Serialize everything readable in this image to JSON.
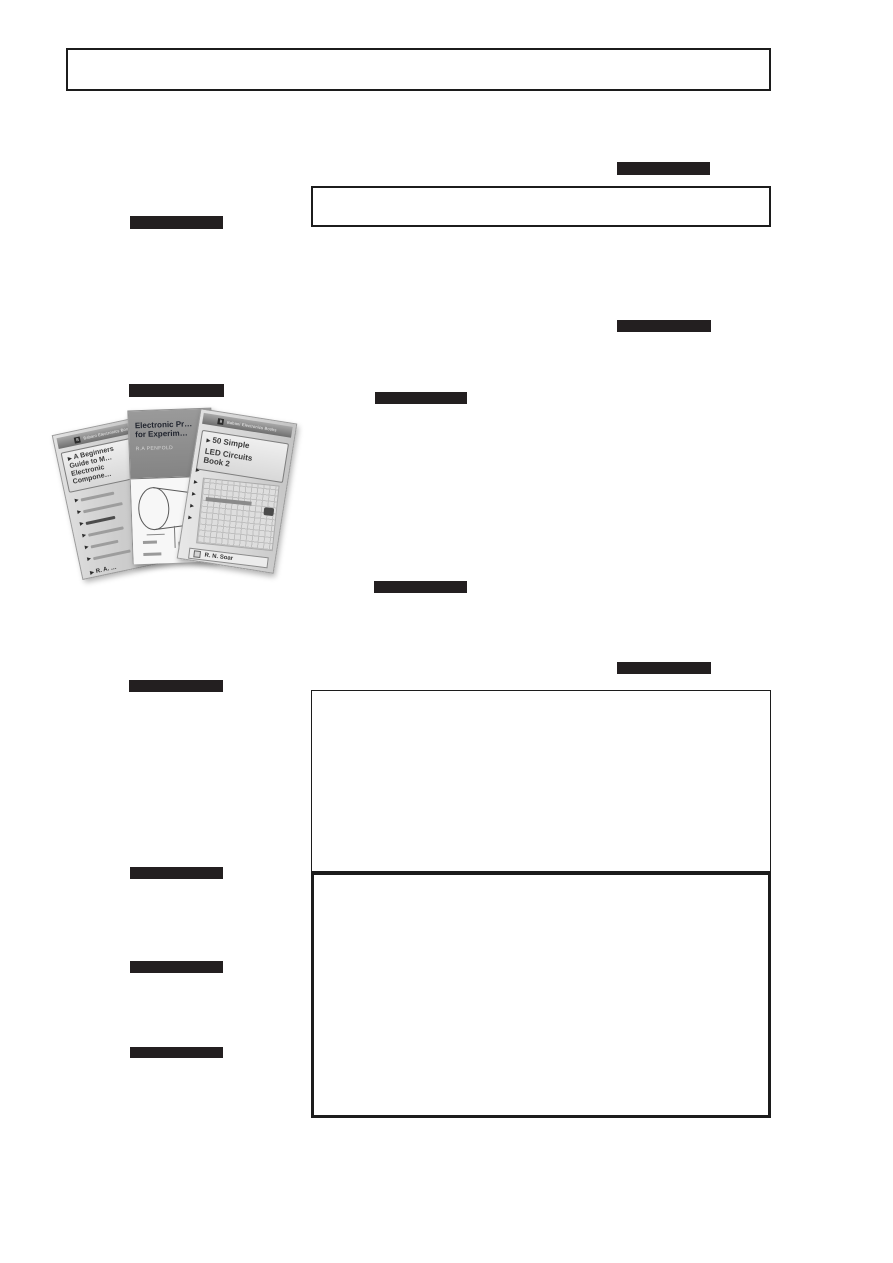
{
  "page": {
    "background_color": "#ffffff",
    "ink_color": "#231f20",
    "border_color": "#1c1c1c"
  },
  "icons": {
    "bullet": "▶",
    "publisher_logo_glyph": "B"
  },
  "books_photo": {
    "left_book": {
      "brand": "Babani Electronics Books",
      "title_line1": "A Beginners",
      "title_line2": "Guide to M…",
      "title_line3": "Electronic",
      "title_line4": "Compone…",
      "author": "R. A. …"
    },
    "middle_book": {
      "title_line1": "Electronic Pr…",
      "title_line2": "for Experim…",
      "author": "R.A PENFOLD"
    },
    "right_book": {
      "brand": "Babani Electronics Books",
      "title_line1": "50 Simple",
      "title_line2": "LED Circuits",
      "title_line3": "Book 2",
      "author": "R. N. Soar"
    }
  }
}
